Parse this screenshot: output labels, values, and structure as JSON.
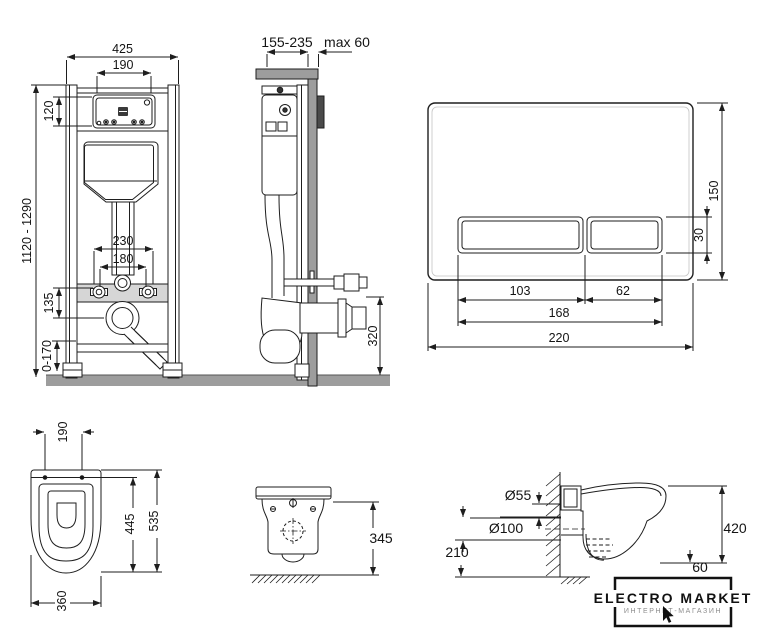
{
  "colors": {
    "line": "#1e1e1e",
    "wall_gray": "#9d9d9d",
    "rail_gray": "#d6d6d6",
    "dark_plate": "#4a4a4a",
    "background": "#ffffff"
  },
  "frame_front": {
    "dim_width": "425",
    "dim_inner_width": "190",
    "dim_box_height": "120",
    "dim_height_range": "1120 - 1290",
    "dim_bolt_spacing": "230",
    "dim_rod_spacing": "180",
    "dim_drain_offset": "135",
    "dim_floor_adjust": "0-170"
  },
  "frame_side": {
    "dim_depth_range": "155-235",
    "dim_max_wall": "max 60",
    "dim_outlet_height": "320"
  },
  "flush_plate": {
    "dim_height": "150",
    "dim_button_height": "30",
    "dim_big_button": "103",
    "dim_small_button": "62",
    "dim_buttons_width": "168",
    "dim_width": "220"
  },
  "toilet_top": {
    "dim_hole_spacing": "190",
    "dim_inner_length": "445",
    "dim_length": "535",
    "dim_width": "360"
  },
  "toilet_front": {
    "dim_height": "345"
  },
  "toilet_side": {
    "dim_flush_pipe": "Ø55",
    "dim_drain_pipe": "Ø100",
    "dim_drain_height": "210",
    "dim_total_height": "420",
    "dim_bottom_gap": "60"
  },
  "logo": {
    "title": "ELECTRO MARKET",
    "subtitle": "ИНТЕРНЕТ-МАГАЗИН"
  }
}
